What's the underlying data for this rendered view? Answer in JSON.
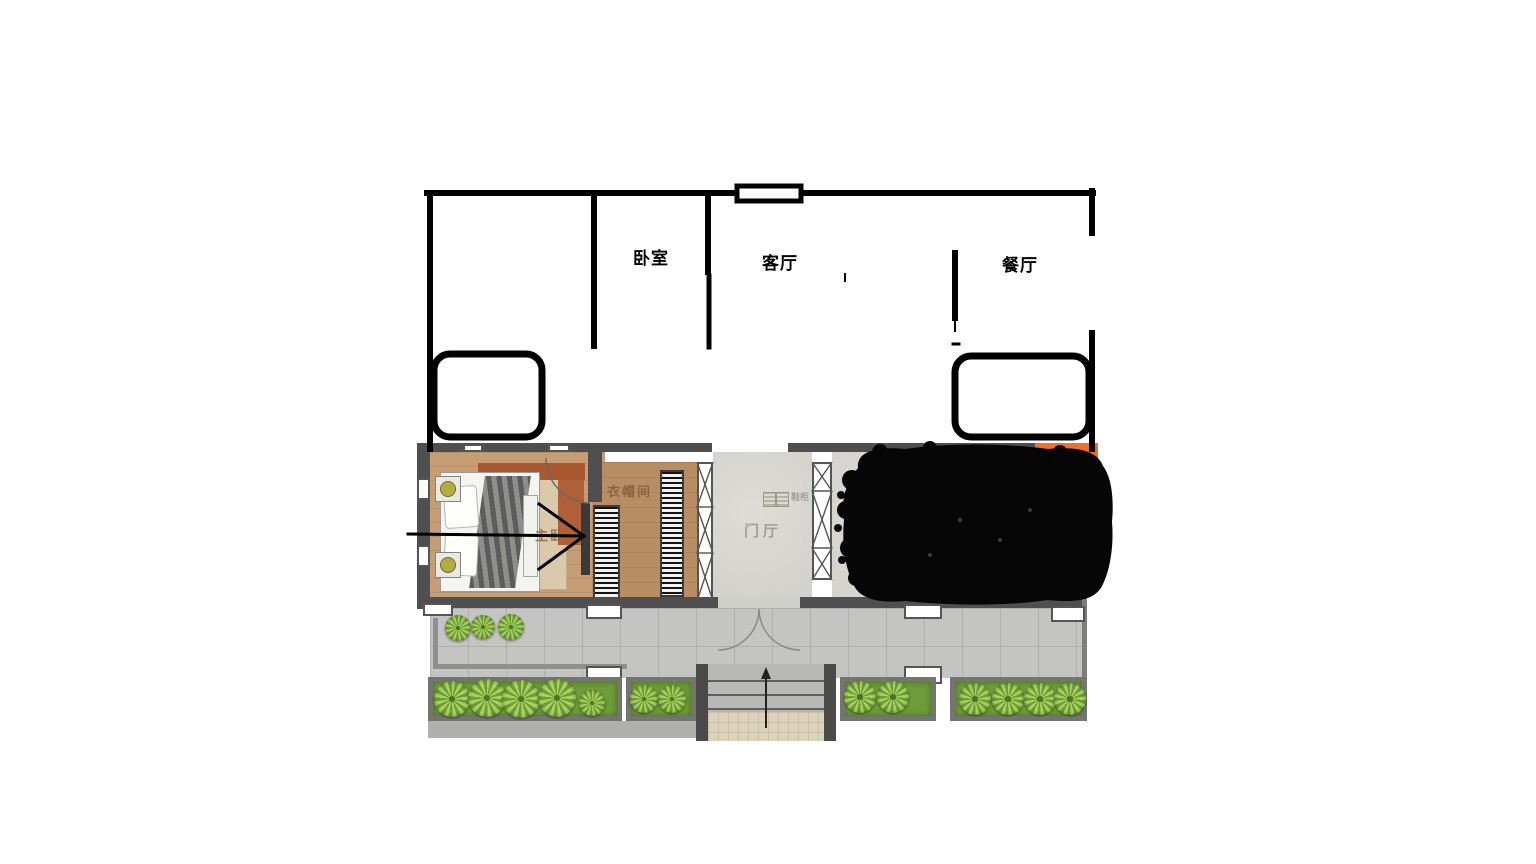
{
  "sketch": {
    "room_labels": [
      {
        "name": "bedroom",
        "label": "卧室"
      },
      {
        "name": "living-room",
        "label": "客厅"
      },
      {
        "name": "dining-room",
        "label": "餐厅"
      }
    ]
  },
  "plan": {
    "room_labels": [
      {
        "name": "master-bedroom",
        "label": "主卧"
      },
      {
        "name": "cloakroom",
        "label": "衣帽间"
      },
      {
        "name": "foyer",
        "label": "门厅"
      },
      {
        "name": "shoe-cabinet",
        "label": "鞋柜"
      }
    ],
    "badge": {
      "label": "进店",
      "bg": "#e8611c",
      "fg": "#ffffff"
    }
  },
  "colors": {
    "sketch_line": "#000000",
    "plan_wall": "#4f4f4f",
    "bedroom_floor": "#c79d76",
    "cloakroom_floor": "#b98d63",
    "foyer_floor": "#d8d6d0",
    "terrace_tile": "#c4c4c2",
    "grass": "#6d9c3a",
    "plant_green": "#a6d45e",
    "scribble": "#060606",
    "accent_rust": "#a8572e"
  }
}
